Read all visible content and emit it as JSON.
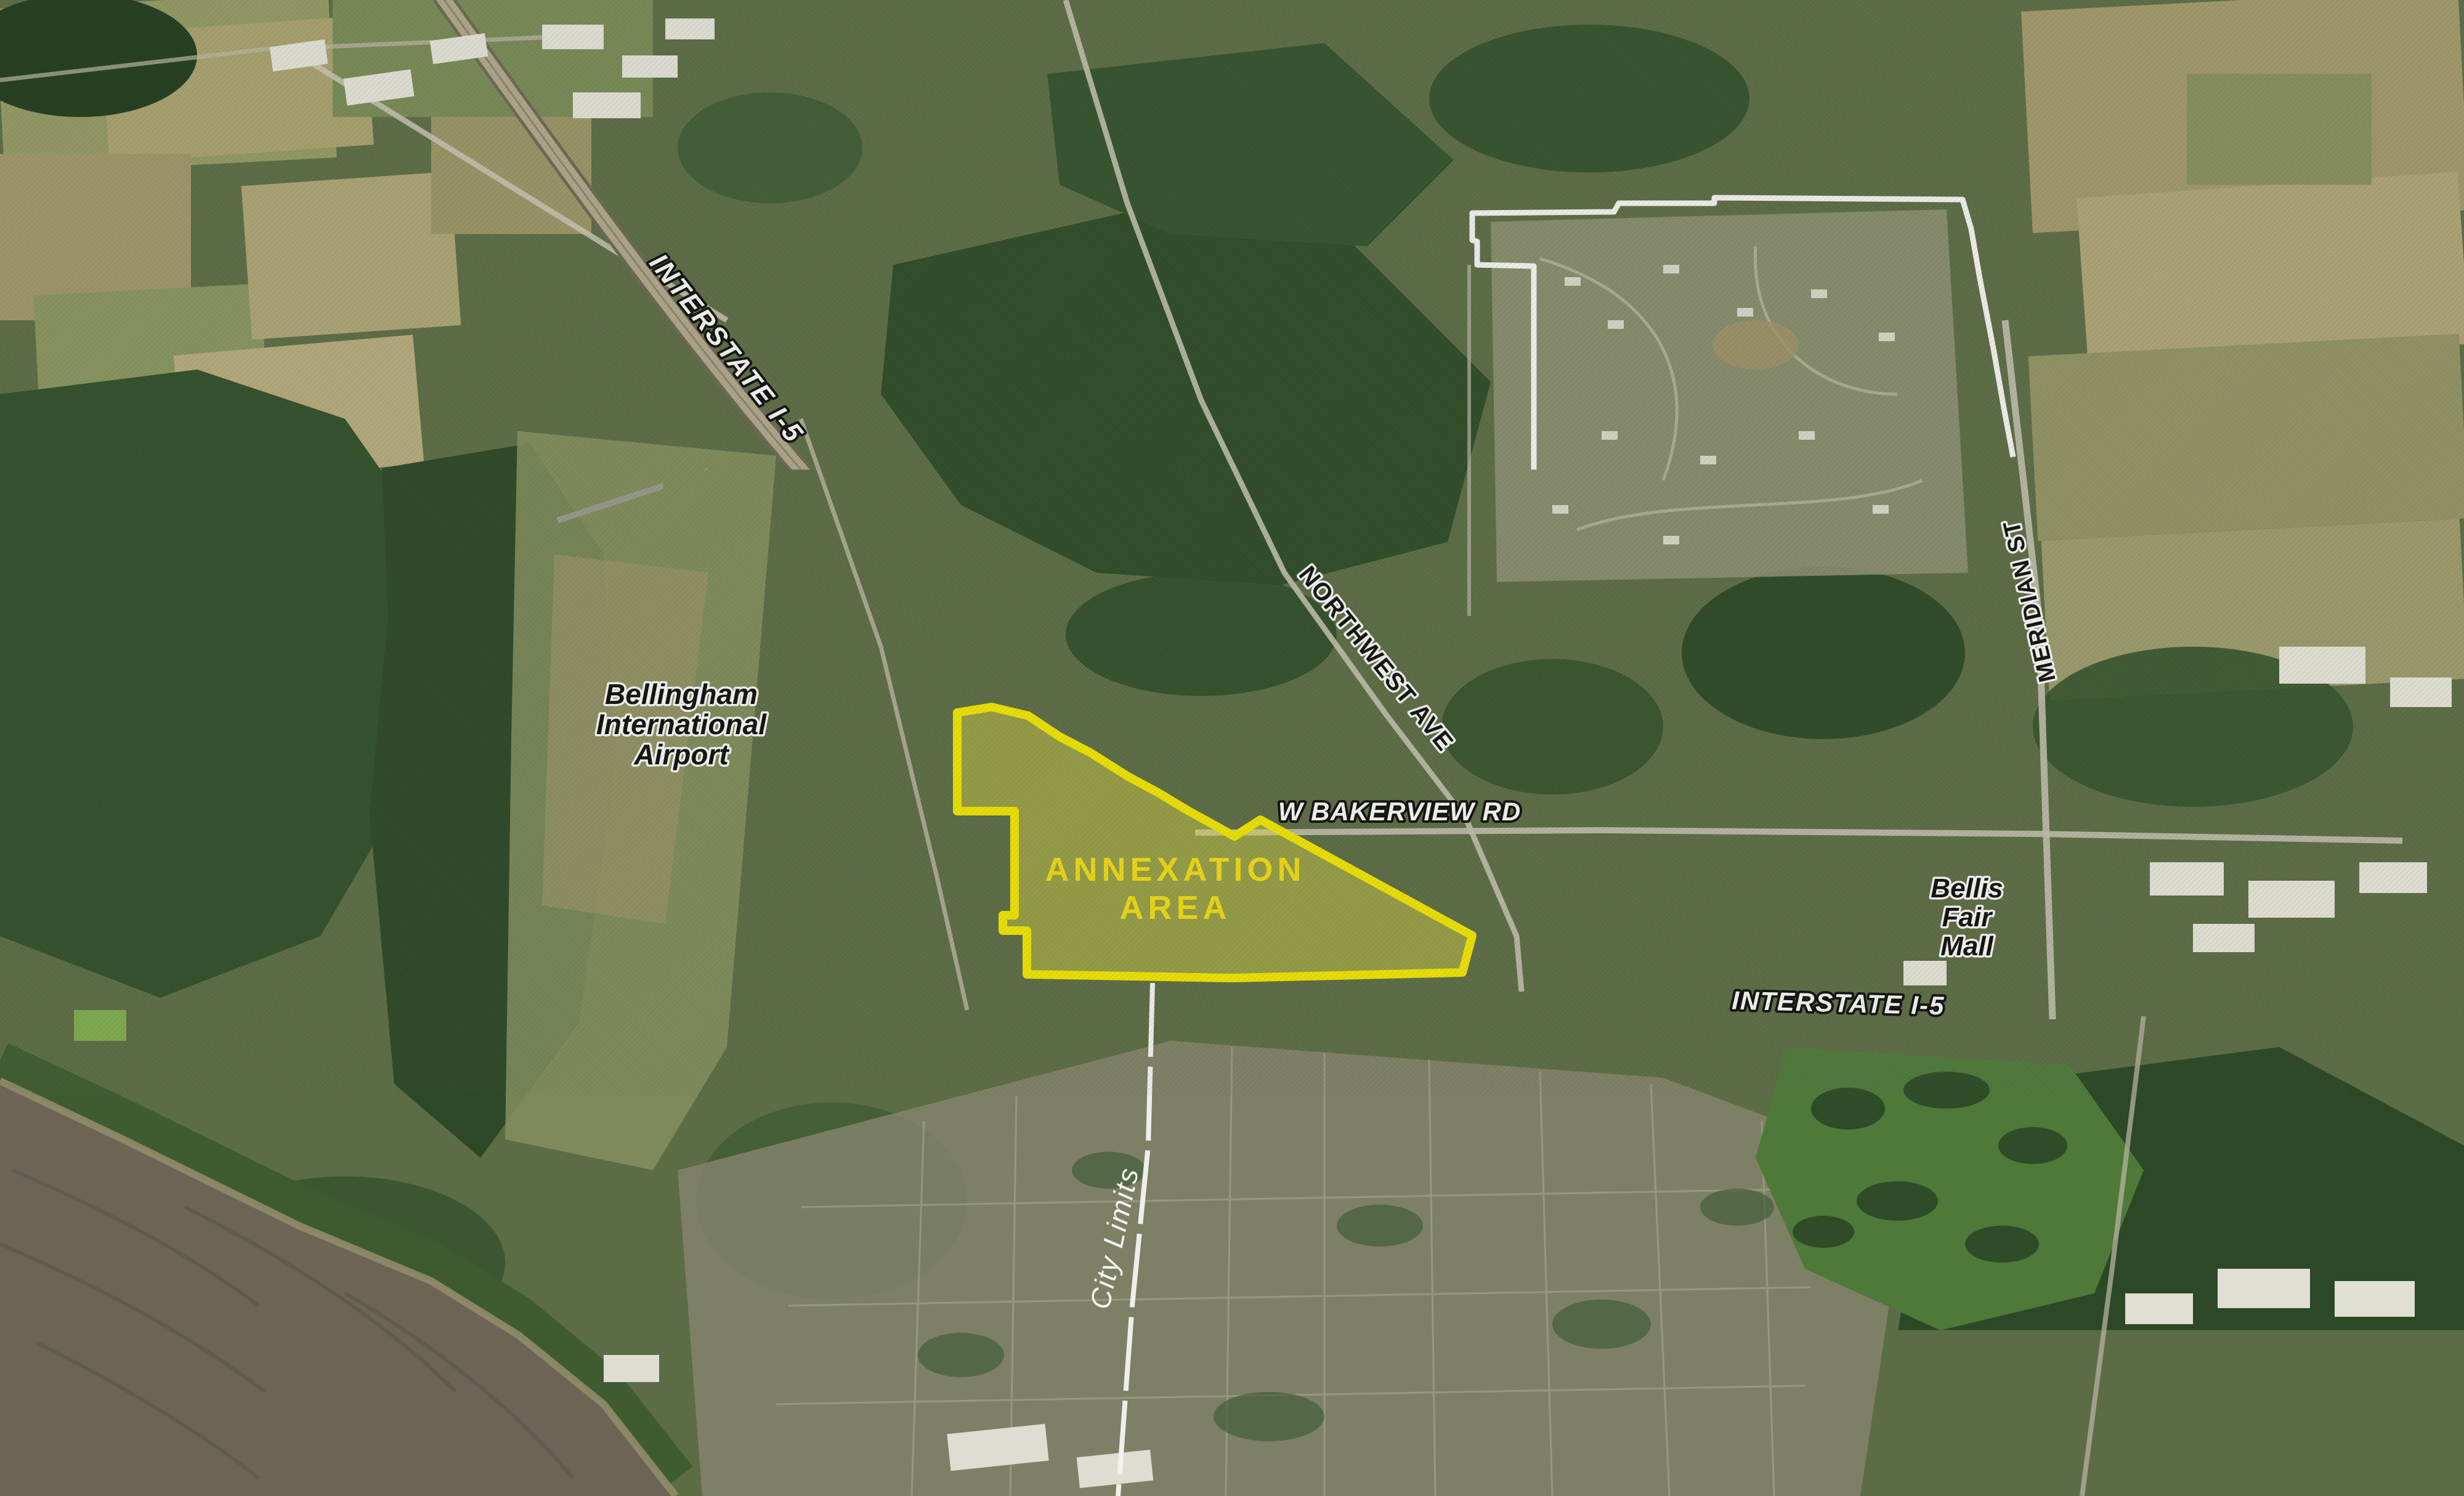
{
  "labels": {
    "interstate_nw": "INTERSTATE I-5",
    "city_limits_top": "City Limits",
    "northwest_ave": "NORTHWEST AVE",
    "meridian_st": "MERIDIAN ST",
    "airport_line1": "Bellingham",
    "airport_line2": "International",
    "airport_line3": "Airport",
    "bakerview_rd": "W BAKERVIEW RD",
    "annexation_line1": "ANNEXATION",
    "annexation_line2": "AREA",
    "bellis_line1": "Bellis",
    "bellis_line2": "Fair",
    "bellis_line3": "Mall",
    "interstate_e": "INTERSTATE I-5",
    "city_limits_bottom": "City Limits"
  },
  "colors": {
    "annexation_fill": "#e6e04a",
    "annexation_stroke": "#f7ea00",
    "annexation_text": "#f6e014",
    "boundary_white": "#ffffff",
    "label_black": "#0e0e0e",
    "label_white": "#ffffff"
  },
  "annexation": {
    "name": "ANNEXATION AREA",
    "polygon_points": "1554,1157 1610,1148 1669,1162 1720,1196 1770,1222 1830,1260 1880,1287 1930,1317 1972,1340 2004,1358 2046,1331 2390,1519 2374,1579 2000,1588 1667,1582 1667,1511 1628,1511 1628,1486 1647,1486 1647,1317 1554,1317"
  },
  "boundaries": {
    "city_limits_upper_d": "M 1431,906 L 1700,894 L 1706,900 L 2090,903 L 2126,982 L 2238,982 L 2264,1010 L 2332,1012 L 2362,984 L 2394,936 L 2394,880 L 2490,878 L 2490,432 L 2398,430 L 2398,392 L 2390,390 L 2390,346 L 2620,344 L 2628,330 L 2783,330 L 2783,321 L 3186,324 L 3200,372 L 3214,452 L 3236,566 L 3254,668 L 3268,742",
    "city_limits_i5_dashes_d": "M 1431,906 L 1662,1158",
    "city_limits_south_d": "M 1871,1596 L 1864,1860 L 1838,2120 L 1815,2429"
  }
}
